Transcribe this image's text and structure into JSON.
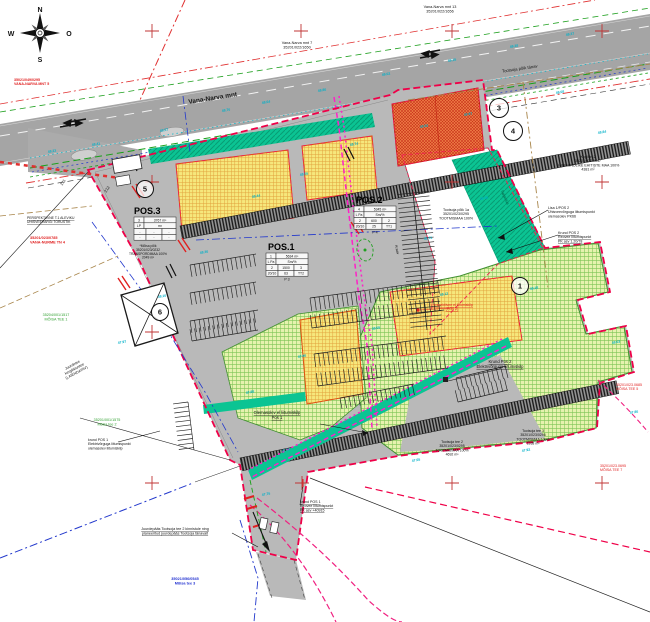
{
  "compass": {
    "north": "N",
    "south": "S",
    "west": "W",
    "east": "O"
  },
  "colors": {
    "boundary_red": "#ef0048",
    "magenta": "#ff20c8",
    "teal": "#0bc493",
    "green_area": "#e6f2ae",
    "yellow_building": "#f6e77c",
    "orange_building": "#f08048",
    "cyan_label": "#00b0c8",
    "road_gray": "#a5a5a5",
    "site_gray": "#b9b9b9"
  },
  "labels": [
    {
      "id": "compass-n",
      "lines": [
        "N"
      ],
      "x": 40,
      "y": 12,
      "s": 7,
      "b": 1
    },
    {
      "id": "compass-s",
      "lines": [
        "S"
      ],
      "x": 40,
      "y": 62,
      "s": 7,
      "b": 1
    },
    {
      "id": "compass-w",
      "lines": [
        "W"
      ],
      "x": 11,
      "y": 36,
      "s": 7,
      "b": 1
    },
    {
      "id": "compass-o",
      "lines": [
        "O"
      ],
      "x": 69,
      "y": 36,
      "s": 7,
      "b": 1
    },
    {
      "id": "vana-narva-mnt-7",
      "lines": [
        "Vana-Narva mnt 7",
        "35201/022/1650"
      ],
      "x": 297,
      "y": 44,
      "s": 3.8
    },
    {
      "id": "vana-narva-mnt-13",
      "lines": [
        "Vana-Narva mnt 13",
        "35201/022/1656"
      ],
      "x": 440,
      "y": 8,
      "s": 3.8
    },
    {
      "id": "road-vana-narva",
      "lines": [
        "Vana-Narva  mnt"
      ],
      "x": 213,
      "y": 100,
      "s": 6.5,
      "r": -9,
      "b": 1,
      "c": "#1a1a1a"
    },
    {
      "id": "road-tootsoja-poik",
      "lines": [
        "Tootsoja põik tänav"
      ],
      "x": 520,
      "y": 70,
      "s": 4.2,
      "r": -8.5
    },
    {
      "id": "kopli-tn-2",
      "lines": [
        "Kopli tn 2",
        "35201/022/1847",
        "ÜHISKONDLIKE EHITISTE MAA 100%",
        "4381 m²"
      ],
      "x": 588,
      "y": 158,
      "s": 3.6
    },
    {
      "id": "lisa1-pos2",
      "lines": [
        "Lisa 1/POS 2",
        "Ühisveevõrguga liitumispunkt",
        "olemasolev PK66"
      ],
      "x": 548,
      "y": 209,
      "s": 3.6,
      "a": "start"
    },
    {
      "id": "krund-pos2-reovee",
      "lines": [
        "Krund POS 2",
        "Reovee liitumispunkt",
        "PK asv 1.20/78"
      ],
      "x": 558,
      "y": 234,
      "s": 3.6,
      "a": "start",
      "u": 1
    },
    {
      "id": "vana-nurme-tn4",
      "lines": [
        "35201/023/0785",
        "VANA-NURME TN 4"
      ],
      "x": 30,
      "y": 239,
      "s": 3.8,
      "c": "#e02020",
      "a": "start",
      "b": 1
    },
    {
      "id": "persp-veevark",
      "lines": [
        "PERSPEKTIIVNE T.1 ALEVIKU",
        "ÜHISVEEVÄRGI TORUSTIK"
      ],
      "x": 27,
      "y": 219,
      "s": 3.4,
      "a": "start",
      "u": 1
    },
    {
      "id": "moisa-tee-1",
      "lines": [
        "35204/001/1517",
        "MÕISA TEE 1"
      ],
      "x": 56,
      "y": 316,
      "s": 3.7,
      "c": "#30a030"
    },
    {
      "id": "moisa-tee-2",
      "lines": [
        "35201/001/1575",
        "Mõisa tee 2"
      ],
      "x": 107,
      "y": 421,
      "s": 3.7,
      "c": "#30a030"
    },
    {
      "id": "laiendatav",
      "lines": [
        "Juurdetee",
        "kergliiklustee",
        "(LAIENDATAV)"
      ],
      "x": 73,
      "y": 366,
      "s": 3.7,
      "r": -28
    },
    {
      "id": "krund-pos1-el",
      "lines": [
        "krund POS 1",
        "Elektrivõrguga liitumispunkt",
        "olemasolev liitumiskilp"
      ],
      "x": 88,
      "y": 441,
      "s": 3.5,
      "a": "start"
    },
    {
      "id": "olemasolev-kilp",
      "lines": [
        "Olemasolev el liitumiskilp",
        "Pos 1"
      ],
      "x": 277,
      "y": 414,
      "s": 4.2,
      "u": 1
    },
    {
      "id": "krund-pos2-el",
      "lines": [
        "Krund Pos 2",
        "Elektrivõrguga liitumiskilp"
      ],
      "x": 500,
      "y": 363,
      "s": 4.2,
      "u": 1
    },
    {
      "id": "krund-pos1-reovee",
      "lines": [
        "krund POS 1",
        "Reovee liitumispunkt",
        "PK asv +40915"
      ],
      "x": 300,
      "y": 503,
      "s": 3.6,
      "a": "start",
      "u": 1
    },
    {
      "id": "juurdepaas",
      "lines": [
        "Juurdepääs Tootsoja tee 2 kinnistule ning",
        "planeeritud juurdepääs Tootsoja tänavalt"
      ],
      "x": 175,
      "y": 530,
      "s": 3.7,
      "u": 1
    },
    {
      "id": "moisa-tee-3",
      "lines": [
        "35021/056/0545",
        "Mõisa tee 3"
      ],
      "x": 185,
      "y": 580,
      "s": 3.8,
      "c": "#2030d0",
      "b": 1
    },
    {
      "id": "vana-narva-mnt-5",
      "lines": [
        "35021/049/0295",
        "VANA-NARVA MNT 5"
      ],
      "x": 14,
      "y": 81,
      "s": 3.6,
      "c": "#e02020",
      "a": "start",
      "b": 1
    },
    {
      "id": "tootsoja-poik-1a",
      "lines": [
        "Tootsoja põik 1a",
        "35201/023/0295",
        "TOOTMISMAA 100%"
      ],
      "x": 456,
      "y": 211,
      "s": 3.6
    },
    {
      "id": "tootsoja-tee-2",
      "lines": [
        "Tootsoja tee 2",
        "35201/023/0295",
        "TOOTMISMAA 100%",
        "4692 m²"
      ],
      "x": 452,
      "y": 443,
      "s": 3.5
    },
    {
      "id": "tootsoja-tee-3",
      "lines": [
        "Tootsoja tee 3",
        "35201/023/0296",
        "TOOTMISMAA 100%",
        "1938 m²"
      ],
      "x": 533,
      "y": 432,
      "s": 3.5
    },
    {
      "id": "moisa-tee-5",
      "lines": [
        "35201/023.0685",
        "MÕISA TEE 5"
      ],
      "x": 616,
      "y": 386,
      "s": 3.6,
      "c": "#e02020",
      "a": "start"
    },
    {
      "id": "moisa-tee-7",
      "lines": [
        "35201/023.0695",
        "MÕISA TEE 7"
      ],
      "x": 600,
      "y": 467,
      "s": 3.6,
      "c": "#e02020",
      "a": "start"
    },
    {
      "id": "moisa-poik",
      "lines": [
        "*Mõisa põik",
        "35201/023/0232",
        "TRANSPORDIMAA 100%",
        "2049 m²"
      ],
      "x": 148,
      "y": 247,
      "s": 3.3
    },
    {
      "id": "persp-el-kilp",
      "lines": [
        "Perspektiivne el liitumiskilp",
        "(POS 2)"
      ],
      "x": 452,
      "y": 306,
      "s": 3.5,
      "c": "#e02020",
      "u": 1
    },
    {
      "id": "parcel-211",
      "lines": [
        "211"
      ],
      "x": 64,
      "y": 183,
      "s": 4,
      "r": -55
    },
    {
      "id": "parcel-212",
      "lines": [
        "212"
      ],
      "x": 108,
      "y": 190,
      "s": 4,
      "r": -55
    },
    {
      "id": "haljastus",
      "lines": [
        "haljastus"
      ],
      "x": 504,
      "y": 198,
      "s": 3.8,
      "r": 66,
      "c": "#055a40"
    },
    {
      "id": "kraav",
      "lines": [
        "Kraav"
      ],
      "x": 396,
      "y": 250,
      "s": 3.5,
      "r": 78
    }
  ],
  "pos_tables": [
    {
      "id": "pos1",
      "title": "POS.1",
      "title_x": 268,
      "title_y": 250,
      "x": 266,
      "y": 253,
      "rows": [
        [
          "1",
          "5634 m²"
        ],
        [
          "L Pa",
          "Sm/%"
        ],
        [
          "2",
          "1500",
          "3"
        ],
        [
          "20/10",
          "63",
          "TT2"
        ]
      ],
      "caption": "P 3"
    },
    {
      "id": "pos2",
      "title": "POS.2",
      "title_x": 356,
      "title_y": 203,
      "x": 354,
      "y": 206,
      "rows": [
        [
          "4",
          "5345 m²"
        ],
        [
          "L Pa",
          "Sm/%"
        ],
        [
          "2",
          "600",
          "2"
        ],
        [
          "20/10",
          "25",
          "TT1"
        ]
      ],
      "caption": "P 4"
    },
    {
      "id": "pos3",
      "title": "POS.3",
      "title_x": 134,
      "title_y": 214,
      "x": 134,
      "y": 217,
      "rows": [
        [
          "3",
          "3767 m²"
        ],
        [
          "LP",
          "m²"
        ],
        [
          "-",
          "-",
          "-"
        ],
        [
          "-",
          "-",
          "-"
        ]
      ],
      "caption": ""
    }
  ],
  "circled_markers": [
    {
      "n": "1",
      "x": 520,
      "y": 286,
      "r": 8.5
    },
    {
      "n": "3",
      "x": 499,
      "y": 108,
      "r": 9.5
    },
    {
      "n": "4",
      "x": 513,
      "y": 131,
      "r": 9.5
    },
    {
      "n": "5",
      "x": 145,
      "y": 189,
      "r": 8.5
    },
    {
      "n": "6",
      "x": 160,
      "y": 312,
      "r": 8.5
    }
  ],
  "grid_crosses": [
    [
      152,
      31
    ],
    [
      301,
      31
    ],
    [
      452,
      31
    ],
    [
      602,
      31
    ],
    [
      152,
      182
    ],
    [
      452,
      182
    ],
    [
      602,
      182
    ],
    [
      152,
      332
    ],
    [
      152,
      483
    ],
    [
      302,
      483
    ],
    [
      452,
      483
    ],
    [
      602,
      483
    ]
  ],
  "elevation_marks": [
    [
      "48.23",
      48,
      153
    ],
    [
      "48.41",
      92,
      146
    ],
    [
      "48.57",
      160,
      132
    ],
    [
      "48.70",
      222,
      112
    ],
    [
      "48.64",
      262,
      104
    ],
    [
      "48.86",
      318,
      92
    ],
    [
      "49.02",
      382,
      76
    ],
    [
      "49.15",
      448,
      62
    ],
    [
      "49.28",
      510,
      48
    ],
    [
      "49.37",
      566,
      36
    ],
    [
      "48.92",
      420,
      128
    ],
    [
      "48.97",
      464,
      116
    ],
    [
      "48.74",
      350,
      146
    ],
    [
      "48.55",
      300,
      176
    ],
    [
      "48.44",
      252,
      198
    ],
    [
      "48.31",
      424,
      240
    ],
    [
      "48.12",
      440,
      296
    ],
    [
      "48.05",
      372,
      330
    ],
    [
      "47.96",
      298,
      358
    ],
    [
      "47.88",
      246,
      394
    ],
    [
      "47.80",
      344,
      424
    ],
    [
      "47.70",
      282,
      452
    ],
    [
      "47.65",
      412,
      462
    ],
    [
      "47.92",
      522,
      452
    ],
    [
      "48.03",
      612,
      344
    ],
    [
      "47.86",
      630,
      414
    ],
    [
      "49.08",
      556,
      94
    ],
    [
      "48.84",
      598,
      134
    ],
    [
      "48.36",
      200,
      254
    ],
    [
      "48.10",
      158,
      298
    ],
    [
      "47.97",
      118,
      344
    ],
    [
      "48.30",
      480,
      200
    ],
    [
      "48.18",
      530,
      290
    ],
    [
      "47.75",
      262,
      496
    ]
  ]
}
